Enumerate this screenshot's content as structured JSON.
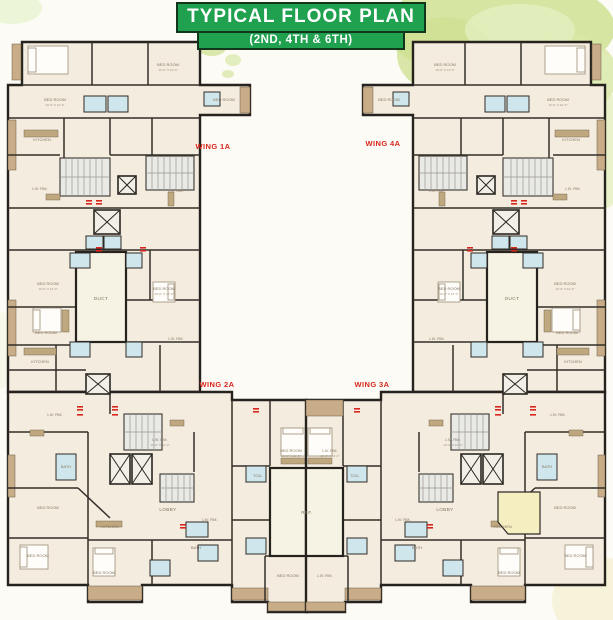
{
  "title": {
    "line1": "TYPICAL FLOOR PLAN",
    "line2": "(2ND, 4TH & 6TH)"
  },
  "wings": {
    "w1a": "WING 1A",
    "w4a": "WING 4A",
    "w2a": "WING 2A",
    "w3a": "WING 3A"
  },
  "rooms": {
    "bed_room": "BED ROOM",
    "living": "LIV. RM.",
    "kitchen": "KITCHEN",
    "toilet": "TOIL.",
    "bath": "BATH",
    "duct": "DUCT",
    "ref": "REF.",
    "lobby": "LOBBY",
    "dim": "10'-0\" X 12'-0\""
  },
  "colors": {
    "banner_green": "#1fa150",
    "wing_label_red": "#d7261d",
    "bathroom_blue": "#cfe7ec",
    "wall_dark": "#2b2723",
    "balcony_tan": "#c8ad88",
    "floor_cream": "#f3ecdf",
    "watercolor_green": "#cfe193"
  }
}
